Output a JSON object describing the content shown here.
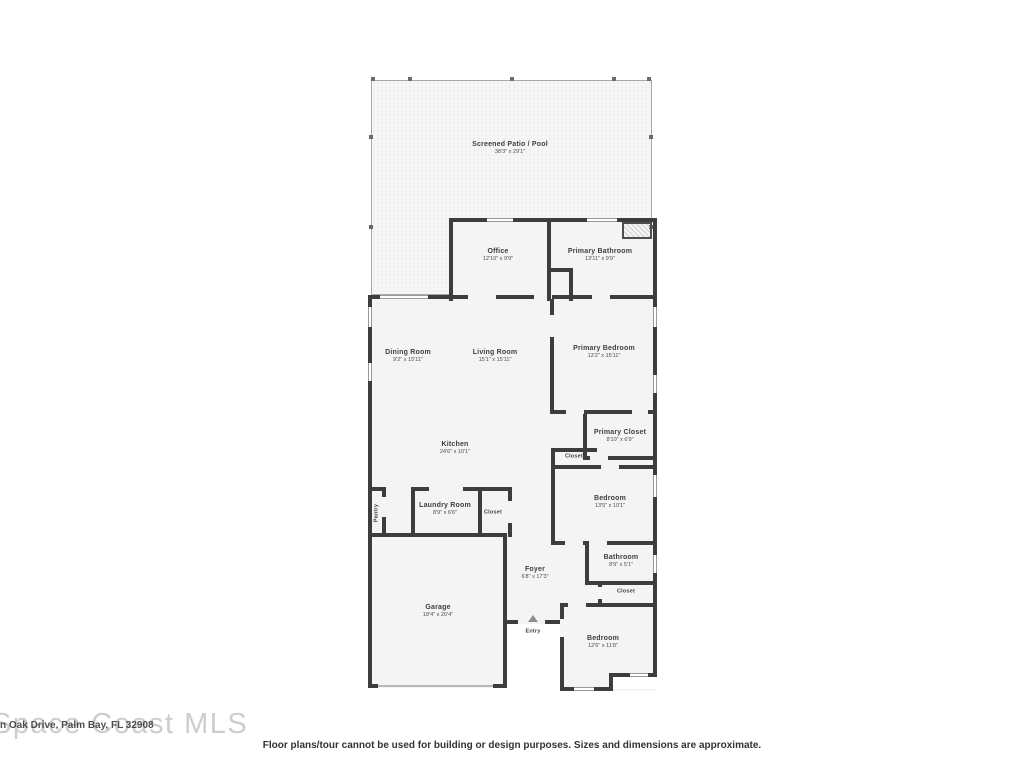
{
  "watermark": {
    "brand": "Space Coast MLS",
    "address_fragment": "n Oak Drive, Palm Bay, FL 32908"
  },
  "disclaimer": "Floor plans/tour cannot be used for building or design purposes. Sizes and dimensions are approximate.",
  "rooms": {
    "patio": {
      "name": "Screened Patio / Pool",
      "dims": "38'3\" x 29'1\""
    },
    "office": {
      "name": "Office",
      "dims": "12'10\" x 9'9\""
    },
    "primary_bathroom": {
      "name": "Primary Bathroom",
      "dims": "13'11\" x 9'9\""
    },
    "dining_room": {
      "name": "Dining Room",
      "dims": "9'2\" x 15'11\""
    },
    "living_room": {
      "name": "Living Room",
      "dims": "15'1\" x 15'11\""
    },
    "primary_bedroom": {
      "name": "Primary Bedroom",
      "dims": "13'2\" x 15'11\""
    },
    "kitchen": {
      "name": "Kitchen",
      "dims": "24'6\" x 10'1\""
    },
    "primary_closet": {
      "name": "Primary Closet",
      "dims": "8'10\" x 6'9\""
    },
    "hall_closet": {
      "name": "Closet"
    },
    "bedroom_middle": {
      "name": "Bedroom",
      "dims": "13'5\" x 10'1\""
    },
    "pantry": {
      "name": "Pantry"
    },
    "laundry_room": {
      "name": "Laundry Room",
      "dims": "8'9\" x 6'6\""
    },
    "laundry_closet": {
      "name": "Closet"
    },
    "foyer": {
      "name": "Foyer",
      "dims": "6'8\" x 17'3\""
    },
    "bathroom": {
      "name": "Bathroom",
      "dims": "8'9\" x 5'1\""
    },
    "bathroom_closet": {
      "name": "Closet"
    },
    "garage": {
      "name": "Garage",
      "dims": "18'4\" x 20'4\""
    },
    "entry": {
      "name": "Entry"
    },
    "bedroom_bottom": {
      "name": "Bedroom",
      "dims": "12'6\" x 11'8\""
    }
  },
  "colors": {
    "wall": "#3d3d3d",
    "patio_dot": "#e0e0e0",
    "interior": "#f4f4f4"
  }
}
